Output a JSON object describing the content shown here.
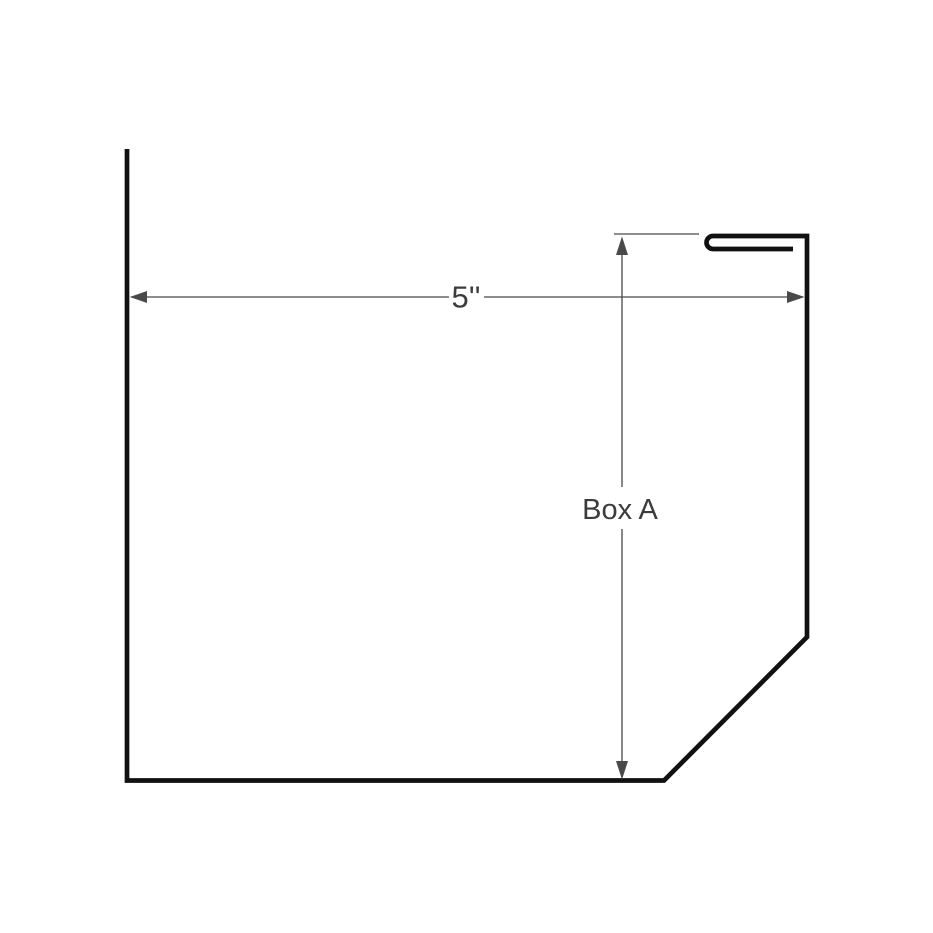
{
  "diagram": {
    "type": "technical-drawing",
    "subject": "sheet-metal box profile cross-section with hemmed top edge",
    "background_color": "#ffffff",
    "outline_color": "#111111",
    "dimension_color": "#494949",
    "label_color": "#3c3c3c",
    "width_dimension": {
      "label": "5''",
      "orientation": "horizontal"
    },
    "height_dimension": {
      "label": "Box A",
      "orientation": "vertical"
    }
  }
}
